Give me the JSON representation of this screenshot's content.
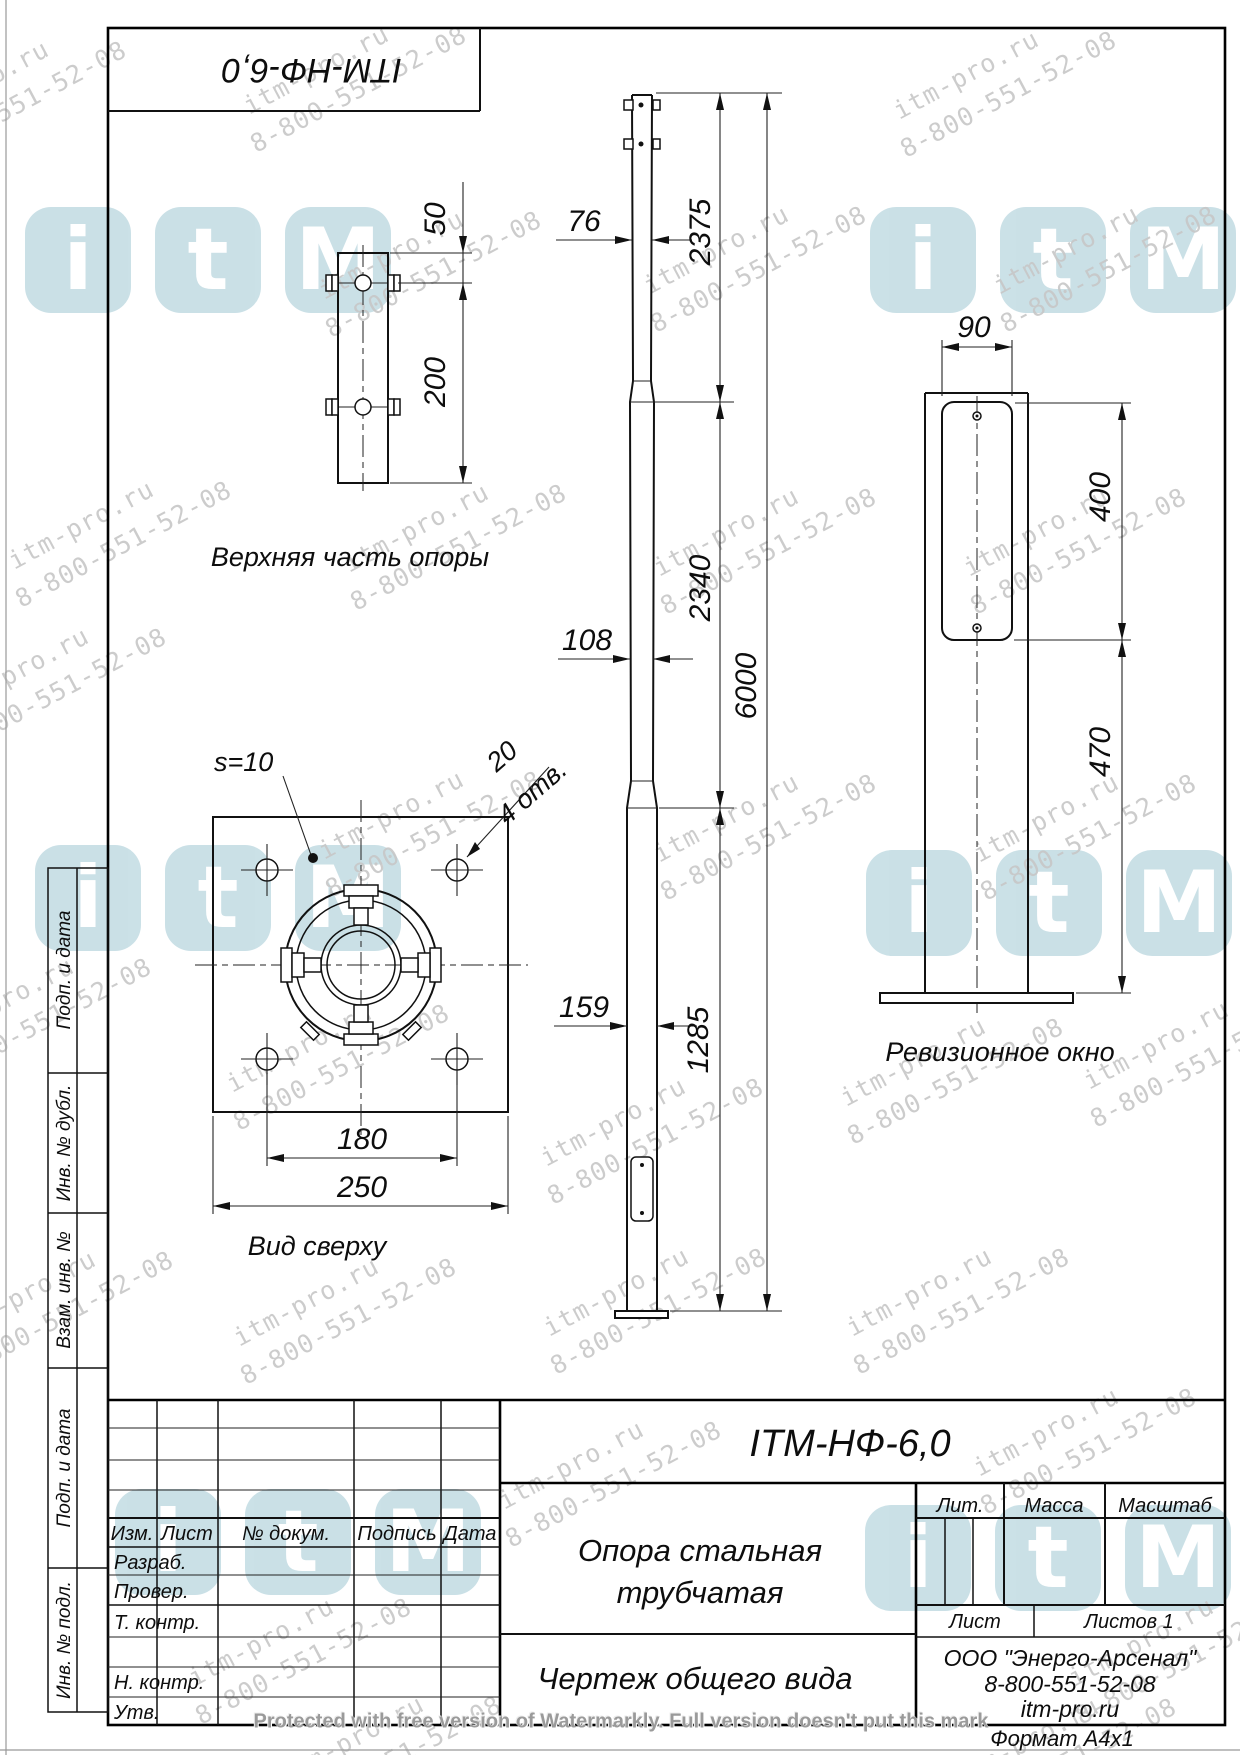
{
  "stamp": {
    "code": "ITM-НФ-6,0"
  },
  "views": {
    "upper_part": {
      "label": "Верхняя часть опоры",
      "dim_offset_top": "50",
      "dim_length": "200"
    },
    "general": {
      "dim_dia_top": "76",
      "dim_len_top": "2375",
      "dim_dia_mid": "108",
      "dim_len_mid": "2340",
      "dim_dia_bottom": "159",
      "dim_len_bottom": "1285",
      "dim_total_height": "6000"
    },
    "plan": {
      "label": "Вид сверху",
      "plate_thickness": "s=10",
      "hole_diameter": "20",
      "hole_count": "4 отв.",
      "dim_hole_spacing": "180",
      "dim_plate_width": "250"
    },
    "window": {
      "label": "Ревизионное окно",
      "dim_width": "90",
      "dim_window_height": "400",
      "dim_bottom_offset": "470"
    }
  },
  "title_block": {
    "designation": "ITM-НФ-6,0",
    "name_line1": "Опора стальная",
    "name_line2": "трубчатая",
    "doc_type": "Чертеж общего вида",
    "col_izm": "Изм.",
    "col_list": "Лист",
    "col_doc": "№ докум.",
    "col_sign": "Подпись",
    "col_date": "Дата",
    "row_razrab": "Разраб.",
    "row_prover": "Провер.",
    "row_tkontr": "Т. контр.",
    "row_nkontr": "Н. контр.",
    "row_utv": "Утв.",
    "lit": "Лит.",
    "mass": "Масса",
    "scale": "Масштаб",
    "sheet": "Лист",
    "sheets": "Листов 1",
    "company": "ООО \"Энерго-Арсенал\"",
    "phone": "8-800-551-52-08",
    "website": "itm-pro.ru",
    "format": "Формат  А4х1"
  },
  "sidebar": {
    "cells": [
      {
        "label": "Подп. и дата"
      },
      {
        "label": "Инв. № дубл."
      },
      {
        "label": "Взам. инв. №"
      },
      {
        "label": "Подп. и дата"
      },
      {
        "label": "Инв. № подл."
      }
    ]
  },
  "watermark": {
    "site": "itm-pro.ru",
    "phone": "8-800-551-52-08",
    "logo_letters": [
      "i",
      "t",
      "M"
    ],
    "protection_notice": "Protected with free version of Watermarkly. Full version doesn't put this mark"
  }
}
